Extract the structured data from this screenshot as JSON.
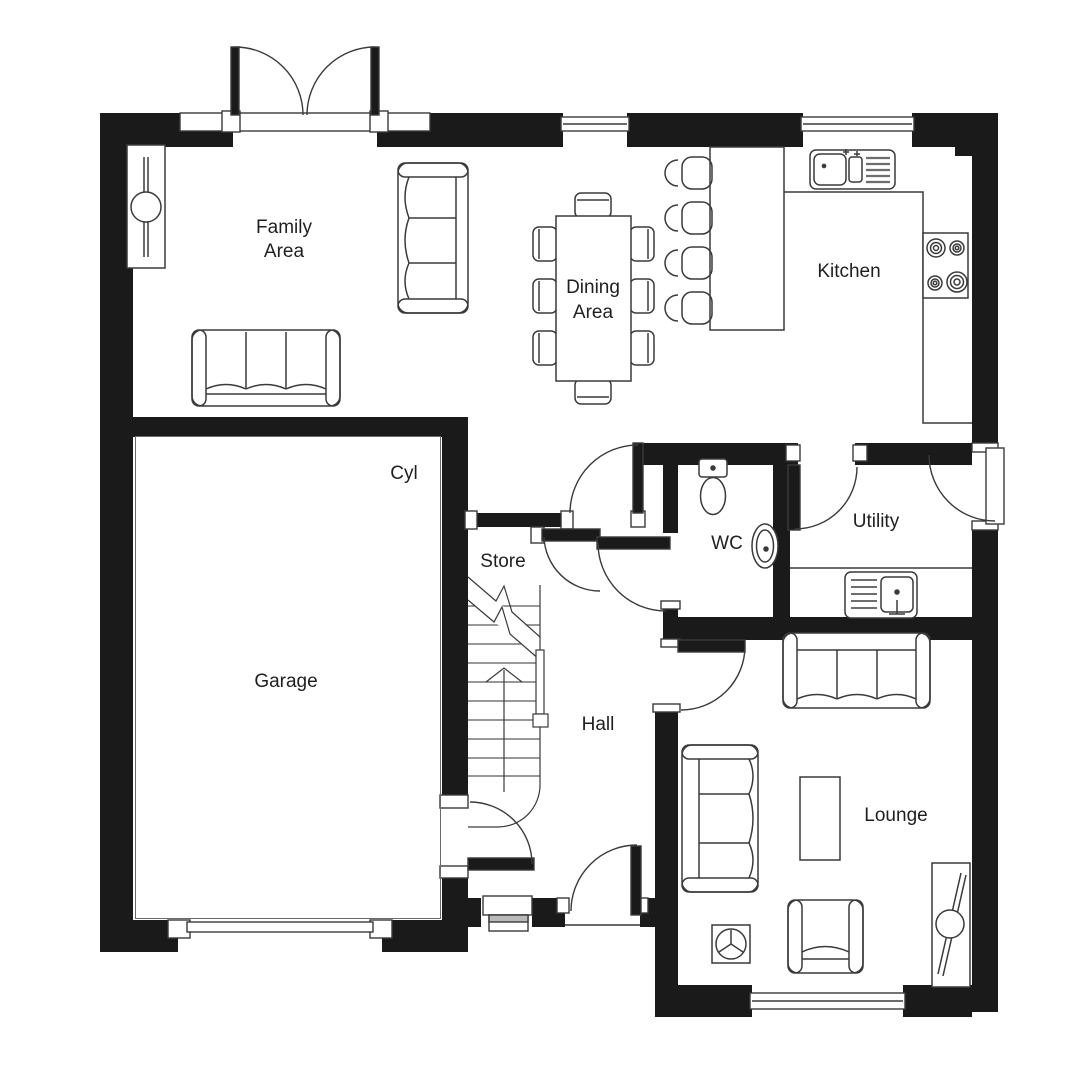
{
  "plan": {
    "type": "floorplan",
    "colors": {
      "wall": "#1a1a1a",
      "line": "#3a3a3a",
      "background": "#ffffff",
      "step_shade": "#b9b9b9"
    },
    "rooms": {
      "family_area": {
        "line1": "Family",
        "line2": "Area"
      },
      "dining_area": {
        "line1": "Dining",
        "line2": "Area"
      },
      "kitchen": {
        "label": "Kitchen"
      },
      "cyl": {
        "label": "Cyl"
      },
      "garage": {
        "label": "Garage"
      },
      "store": {
        "label": "Store"
      },
      "wc": {
        "label": "WC"
      },
      "utility": {
        "label": "Utility"
      },
      "hall": {
        "label": "Hall"
      },
      "lounge": {
        "label": "Lounge"
      }
    },
    "symbols": [
      "french-doors-icon",
      "window-icon",
      "door-swing-icon",
      "stairs-icon",
      "stairs-break-line-icon",
      "up-arrow-icon",
      "sofa-3-seat-icon",
      "armchair-icon",
      "coffee-table-icon",
      "side-table-icon",
      "tv-unit-icon",
      "dining-table-icon",
      "dining-chair-icon",
      "bar-stool-icon",
      "breakfast-bar-icon",
      "kitchen-sink-icon",
      "hob-icon",
      "utility-sink-icon",
      "toilet-icon",
      "wash-basin-icon",
      "worktop-icon"
    ]
  }
}
